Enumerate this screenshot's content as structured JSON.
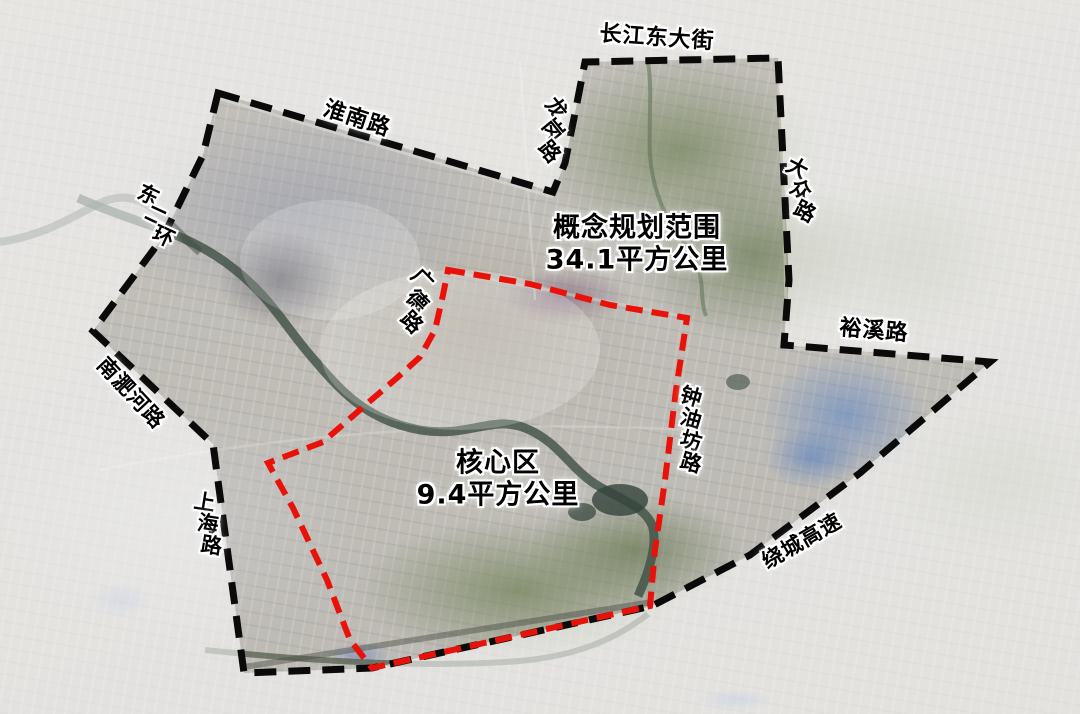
{
  "areas": {
    "planning_scope": {
      "label": "概念规划范围",
      "area": "34.1平方公里"
    },
    "core_area": {
      "label": "核心区",
      "area": "9.4平方公里"
    }
  },
  "roads": [
    {
      "id": "changjiang-east-street",
      "name": "长江东大街"
    },
    {
      "id": "huainan-road",
      "name": "淮南路"
    },
    {
      "id": "longgang-road",
      "name": "龙岗路"
    },
    {
      "id": "dazhong-road",
      "name": "大众路"
    },
    {
      "id": "dong-er-huan",
      "name": "东二环"
    },
    {
      "id": "guangde-road",
      "name": "广德路"
    },
    {
      "id": "yuxi-road",
      "name": "裕溪路"
    },
    {
      "id": "nanfeihe-road",
      "name": "南淝河路"
    },
    {
      "id": "zhongyoufang-road",
      "name": "钟油坊路"
    },
    {
      "id": "shanghai-road",
      "name": "上海路"
    },
    {
      "id": "raocheng-expressway",
      "name": "绕城高速"
    }
  ],
  "colors": {
    "planning_boundary": "#0a0a0a",
    "core_boundary": "#e8120a",
    "label_text": "#000000",
    "label_halo": "#ffffff",
    "outside_fade": "#ffffff"
  }
}
